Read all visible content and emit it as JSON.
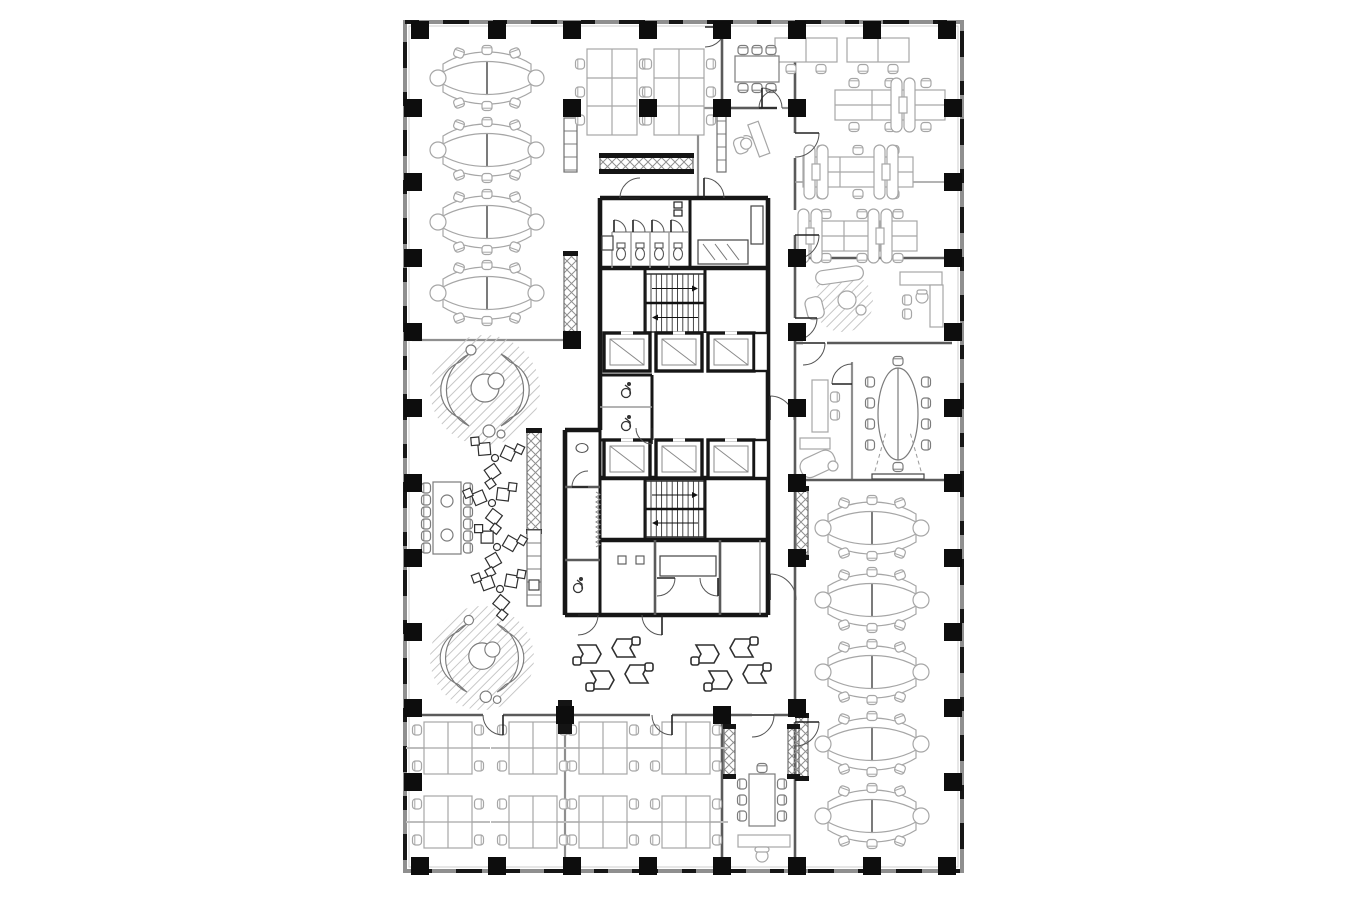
{
  "meta": {
    "description_label": "office-floor-plan",
    "colors": {
      "bg": "#ffffff",
      "wall_dark": "#161616",
      "wall_mid": "#5a5a5a",
      "wall_light": "#8f8f8f",
      "thin": "#9a9a9a",
      "furn_light": "#a6a6a6",
      "furn_mid": "#7b7b7b",
      "furn_bold": "#2f2f2f",
      "hatch": "#c6c6c6"
    }
  },
  "canvas": {
    "w": 1360,
    "h": 900
  },
  "outer": {
    "x": 405,
    "y": 22,
    "w": 557,
    "h": 849
  },
  "columns": {
    "size": 18,
    "points": [
      [
        420,
        30
      ],
      [
        497,
        30
      ],
      [
        572,
        30
      ],
      [
        648,
        30
      ],
      [
        722,
        30
      ],
      [
        797,
        30
      ],
      [
        872,
        30
      ],
      [
        947,
        30
      ],
      [
        420,
        866
      ],
      [
        497,
        866
      ],
      [
        572,
        866
      ],
      [
        648,
        866
      ],
      [
        722,
        866
      ],
      [
        797,
        866
      ],
      [
        872,
        866
      ],
      [
        947,
        866
      ],
      [
        413,
        108
      ],
      [
        413,
        182
      ],
      [
        413,
        258
      ],
      [
        413,
        332
      ],
      [
        413,
        408
      ],
      [
        413,
        483
      ],
      [
        413,
        558
      ],
      [
        413,
        632
      ],
      [
        413,
        708
      ],
      [
        413,
        782
      ],
      [
        953,
        108
      ],
      [
        953,
        182
      ],
      [
        953,
        258
      ],
      [
        953,
        332
      ],
      [
        953,
        408
      ],
      [
        953,
        483
      ],
      [
        953,
        558
      ],
      [
        953,
        632
      ],
      [
        953,
        708
      ],
      [
        953,
        782
      ],
      [
        572,
        108
      ],
      [
        648,
        108
      ],
      [
        722,
        108
      ],
      [
        797,
        108
      ],
      [
        572,
        340
      ],
      [
        797,
        258
      ],
      [
        797,
        332
      ],
      [
        797,
        408
      ],
      [
        797,
        483
      ],
      [
        797,
        558
      ],
      [
        797,
        708
      ],
      [
        722,
        715
      ],
      [
        565,
        715
      ]
    ]
  },
  "walls": [
    [
      412,
      340,
      578,
      340,
      "g"
    ],
    [
      795,
      27,
      795,
      133,
      "d"
    ],
    [
      795,
      158,
      795,
      210,
      "d"
    ],
    [
      795,
      235,
      795,
      318,
      "d"
    ],
    [
      795,
      340,
      795,
      700,
      "d"
    ],
    [
      795,
      722,
      795,
      868,
      "d"
    ],
    [
      795,
      182,
      952,
      182,
      "t"
    ],
    [
      795,
      258,
      952,
      258,
      "d"
    ],
    [
      795,
      343,
      803,
      343,
      "d"
    ],
    [
      827,
      343,
      952,
      343,
      "d"
    ],
    [
      852,
      362,
      852,
      480,
      "g"
    ],
    [
      795,
      480,
      952,
      480,
      "d"
    ],
    [
      412,
      715,
      483,
      715,
      "d"
    ],
    [
      503,
      715,
      650,
      715,
      "d"
    ],
    [
      672,
      715,
      722,
      715,
      "d"
    ],
    [
      722,
      715,
      752,
      715,
      "d"
    ],
    [
      774,
      715,
      800,
      715,
      "d"
    ],
    [
      565,
      715,
      565,
      868,
      "g"
    ],
    [
      722,
      715,
      722,
      868,
      "d"
    ],
    [
      698,
      108,
      698,
      198,
      "g"
    ],
    [
      698,
      108,
      762,
      108,
      "g"
    ],
    [
      782,
      108,
      795,
      108,
      "g"
    ],
    [
      722,
      27,
      722,
      108,
      "d"
    ],
    [
      722,
      108,
      777,
      108,
      "d"
    ],
    [
      600,
      198,
      768,
      198,
      "k"
    ],
    [
      768,
      198,
      768,
      615,
      "k"
    ],
    [
      565,
      615,
      768,
      615,
      "k"
    ],
    [
      600,
      198,
      600,
      430,
      "k"
    ],
    [
      565,
      430,
      600,
      430,
      "k"
    ],
    [
      565,
      430,
      565,
      615,
      "k"
    ],
    [
      600,
      430,
      600,
      615,
      "k3"
    ],
    [
      600,
      268,
      768,
      268,
      "k"
    ],
    [
      690,
      198,
      690,
      268,
      "k3"
    ],
    [
      645,
      268,
      645,
      333,
      "k3"
    ],
    [
      705,
      268,
      705,
      333,
      "k3"
    ],
    [
      600,
      375,
      652,
      375,
      "k3"
    ],
    [
      652,
      375,
      652,
      440,
      "k3"
    ],
    [
      600,
      440,
      652,
      440,
      "k3"
    ],
    [
      600,
      407,
      652,
      407,
      "t"
    ],
    [
      600,
      478,
      768,
      478,
      "k"
    ],
    [
      645,
      480,
      645,
      538,
      "k3"
    ],
    [
      705,
      480,
      705,
      538,
      "k3"
    ],
    [
      600,
      540,
      768,
      540,
      "k"
    ],
    [
      655,
      540,
      655,
      615,
      "d"
    ],
    [
      720,
      540,
      720,
      615,
      "d"
    ],
    [
      760,
      540,
      760,
      615,
      "t"
    ],
    [
      565,
      487,
      600,
      487,
      "d"
    ],
    [
      565,
      560,
      600,
      560,
      "d"
    ],
    [
      612,
      232,
      688,
      232,
      "t"
    ],
    [
      612,
      232,
      612,
      268,
      "t"
    ],
    [
      631,
      232,
      631,
      268,
      "t"
    ],
    [
      650,
      232,
      650,
      268,
      "t"
    ],
    [
      669,
      232,
      669,
      268,
      "t"
    ]
  ],
  "doors": [
    [
      640,
      198,
      20,
      180,
      270
    ],
    [
      704,
      198,
      20,
      270,
      360
    ],
    [
      777,
      108,
      18,
      180,
      270
    ],
    [
      762,
      108,
      20,
      270,
      360
    ],
    [
      795,
      133,
      24,
      0,
      90
    ],
    [
      795,
      235,
      24,
      0,
      90
    ],
    [
      795,
      318,
      22,
      0,
      90
    ],
    [
      803,
      343,
      22,
      0,
      90
    ],
    [
      852,
      384,
      20,
      180,
      270
    ],
    [
      795,
      722,
      24,
      0,
      90
    ],
    [
      503,
      715,
      20,
      90,
      180
    ],
    [
      672,
      715,
      20,
      90,
      180
    ],
    [
      752,
      715,
      22,
      0,
      90
    ],
    [
      770,
      420,
      24,
      270,
      360
    ],
    [
      770,
      600,
      26,
      270,
      360
    ],
    [
      578,
      615,
      20,
      0,
      90
    ],
    [
      662,
      615,
      20,
      90,
      180
    ],
    [
      588,
      487,
      16,
      180,
      270
    ],
    [
      652,
      428,
      16,
      90,
      180
    ],
    [
      657,
      578,
      18,
      0,
      90
    ],
    [
      718,
      578,
      18,
      90,
      180
    ],
    [
      705,
      27,
      20,
      0,
      90
    ],
    [
      614,
      232,
      12,
      270,
      360
    ],
    [
      633,
      232,
      12,
      270,
      360
    ],
    [
      652,
      232,
      12,
      270,
      360
    ],
    [
      671,
      232,
      12,
      270,
      360
    ]
  ],
  "stairs": [
    {
      "x": 646,
      "y": 274,
      "w": 58,
      "h": 58
    },
    {
      "x": 646,
      "y": 481,
      "w": 58,
      "h": 56
    }
  ],
  "elevators": [
    {
      "x": 604,
      "y": 333,
      "w": 46,
      "h": 38
    },
    {
      "x": 656,
      "y": 333,
      "w": 46,
      "h": 38
    },
    {
      "x": 708,
      "y": 333,
      "w": 46,
      "h": 38
    },
    {
      "x": 604,
      "y": 440,
      "w": 46,
      "h": 38
    },
    {
      "x": 656,
      "y": 440,
      "w": 46,
      "h": 38
    },
    {
      "x": 708,
      "y": 440,
      "w": 46,
      "h": 38
    }
  ],
  "cabinets": [
    {
      "k": "x",
      "x": 564,
      "y": 255,
      "w": 13,
      "h": 80
    },
    {
      "k": "x",
      "x": 527,
      "y": 432,
      "w": 14,
      "h": 98
    },
    {
      "k": "x",
      "x": 796,
      "y": 490,
      "w": 12,
      "h": 66
    },
    {
      "k": "x",
      "x": 796,
      "y": 717,
      "w": 12,
      "h": 60
    },
    {
      "k": "x",
      "x": 724,
      "y": 728,
      "w": 11,
      "h": 47
    },
    {
      "k": "x",
      "x": 788,
      "y": 728,
      "w": 11,
      "h": 47
    },
    {
      "k": "x",
      "x": 600,
      "y": 157,
      "w": 93,
      "h": 13
    },
    {
      "k": "l",
      "x": 564,
      "y": 118,
      "w": 13,
      "h": 54
    },
    {
      "k": "l",
      "x": 527,
      "y": 530,
      "w": 14,
      "h": 76
    },
    {
      "k": "l",
      "x": 717,
      "y": 108,
      "w": 9,
      "h": 64
    }
  ],
  "lounges": [
    {
      "x": 485,
      "y": 390,
      "r": 55
    },
    {
      "x": 482,
      "y": 658,
      "r": 52
    }
  ],
  "furniture": [
    [
      "xcluster",
      487,
      78,
      0
    ],
    [
      "xcluster",
      487,
      150,
      0
    ],
    [
      "xcluster",
      487,
      222,
      0
    ],
    [
      "xcluster",
      487,
      293,
      0
    ],
    [
      "xcluster",
      872,
      528,
      0
    ],
    [
      "xcluster",
      872,
      600,
      0
    ],
    [
      "xcluster",
      872,
      672,
      0
    ],
    [
      "xcluster",
      872,
      744,
      0
    ],
    [
      "xcluster",
      872,
      816,
      0
    ],
    [
      "bench6",
      612,
      92,
      0
    ],
    [
      "bench6",
      679,
      92,
      0
    ],
    [
      "benchrow",
      890,
      105,
      0
    ],
    [
      "benchrow",
      858,
      172,
      0
    ],
    [
      "benchrow",
      862,
      236,
      0
    ],
    [
      "pills",
      903,
      105,
      0
    ],
    [
      "pills",
      816,
      172,
      0
    ],
    [
      "pills",
      886,
      172,
      0
    ],
    [
      "pills",
      810,
      236,
      0
    ],
    [
      "pills",
      880,
      236,
      0
    ],
    [
      "walldesk2",
      806,
      50,
      0
    ],
    [
      "walldesk2",
      878,
      50,
      0
    ],
    [
      "mtable8h",
      757,
      69,
      0
    ],
    [
      "persondesk",
      748,
      143,
      -20
    ],
    [
      "console",
      820,
      406,
      0
    ],
    [
      "chaise",
      816,
      458,
      0
    ],
    [
      "ovalconf",
      898,
      414,
      0
    ],
    [
      "execlounge",
      843,
      300,
      0
    ],
    [
      "ldesk",
      922,
      300,
      0
    ],
    [
      "longtable12",
      447,
      518,
      0
    ],
    [
      "tri3",
      495,
      458,
      10
    ],
    [
      "tri3",
      492,
      503,
      -8
    ],
    [
      "tri3",
      497,
      547,
      15
    ],
    [
      "tri3",
      500,
      589,
      -5
    ],
    [
      "hex4",
      612,
      666,
      0
    ],
    [
      "hex4",
      730,
      666,
      0
    ],
    [
      "quad",
      448,
      748,
      0
    ],
    [
      "quad",
      533,
      748,
      0
    ],
    [
      "quad",
      448,
      822,
      0
    ],
    [
      "quad",
      533,
      822,
      0
    ],
    [
      "quad",
      603,
      748,
      0
    ],
    [
      "quad",
      686,
      748,
      0
    ],
    [
      "quad",
      603,
      822,
      0
    ],
    [
      "quad",
      686,
      822,
      0
    ],
    [
      "mtable8v",
      762,
      800,
      0
    ],
    [
      "sideboard",
      764,
      841,
      0
    ],
    [
      "deskchair",
      762,
      856,
      0
    ]
  ],
  "fixtures": {
    "toilets": [
      [
        621,
        253
      ],
      [
        640,
        253
      ],
      [
        659,
        253
      ],
      [
        678,
        253
      ]
    ],
    "urinals": [
      [
        622,
        560
      ],
      [
        640,
        560
      ]
    ],
    "sink_ovals": [
      [
        676,
        566
      ],
      [
        700,
        566
      ],
      [
        582,
        448
      ]
    ],
    "wheelchairs": [
      [
        626,
        391
      ],
      [
        626,
        424
      ],
      [
        578,
        586
      ]
    ],
    "panels": [
      [
        678,
        205
      ],
      [
        678,
        213
      ]
    ],
    "rects": [
      {
        "x": 602,
        "y": 236,
        "w": 11,
        "h": 14
      },
      {
        "x": 751,
        "y": 206,
        "w": 12,
        "h": 38
      },
      {
        "x": 698,
        "y": 240,
        "w": 50,
        "h": 24
      },
      {
        "x": 660,
        "y": 556,
        "w": 56,
        "h": 20
      },
      {
        "x": 872,
        "y": 474,
        "w": 52,
        "h": 5
      },
      {
        "x": 529,
        "y": 580,
        "w": 10,
        "h": 10
      }
    ],
    "pier": {
      "x": 558,
      "y": 700,
      "w": 14,
      "h": 34
    },
    "radiator": {
      "x": 596,
      "y1": 492,
      "y2": 545
    },
    "projection": [
      [
        873,
        478,
        886,
        432
      ],
      [
        923,
        478,
        910,
        432
      ]
    ]
  }
}
